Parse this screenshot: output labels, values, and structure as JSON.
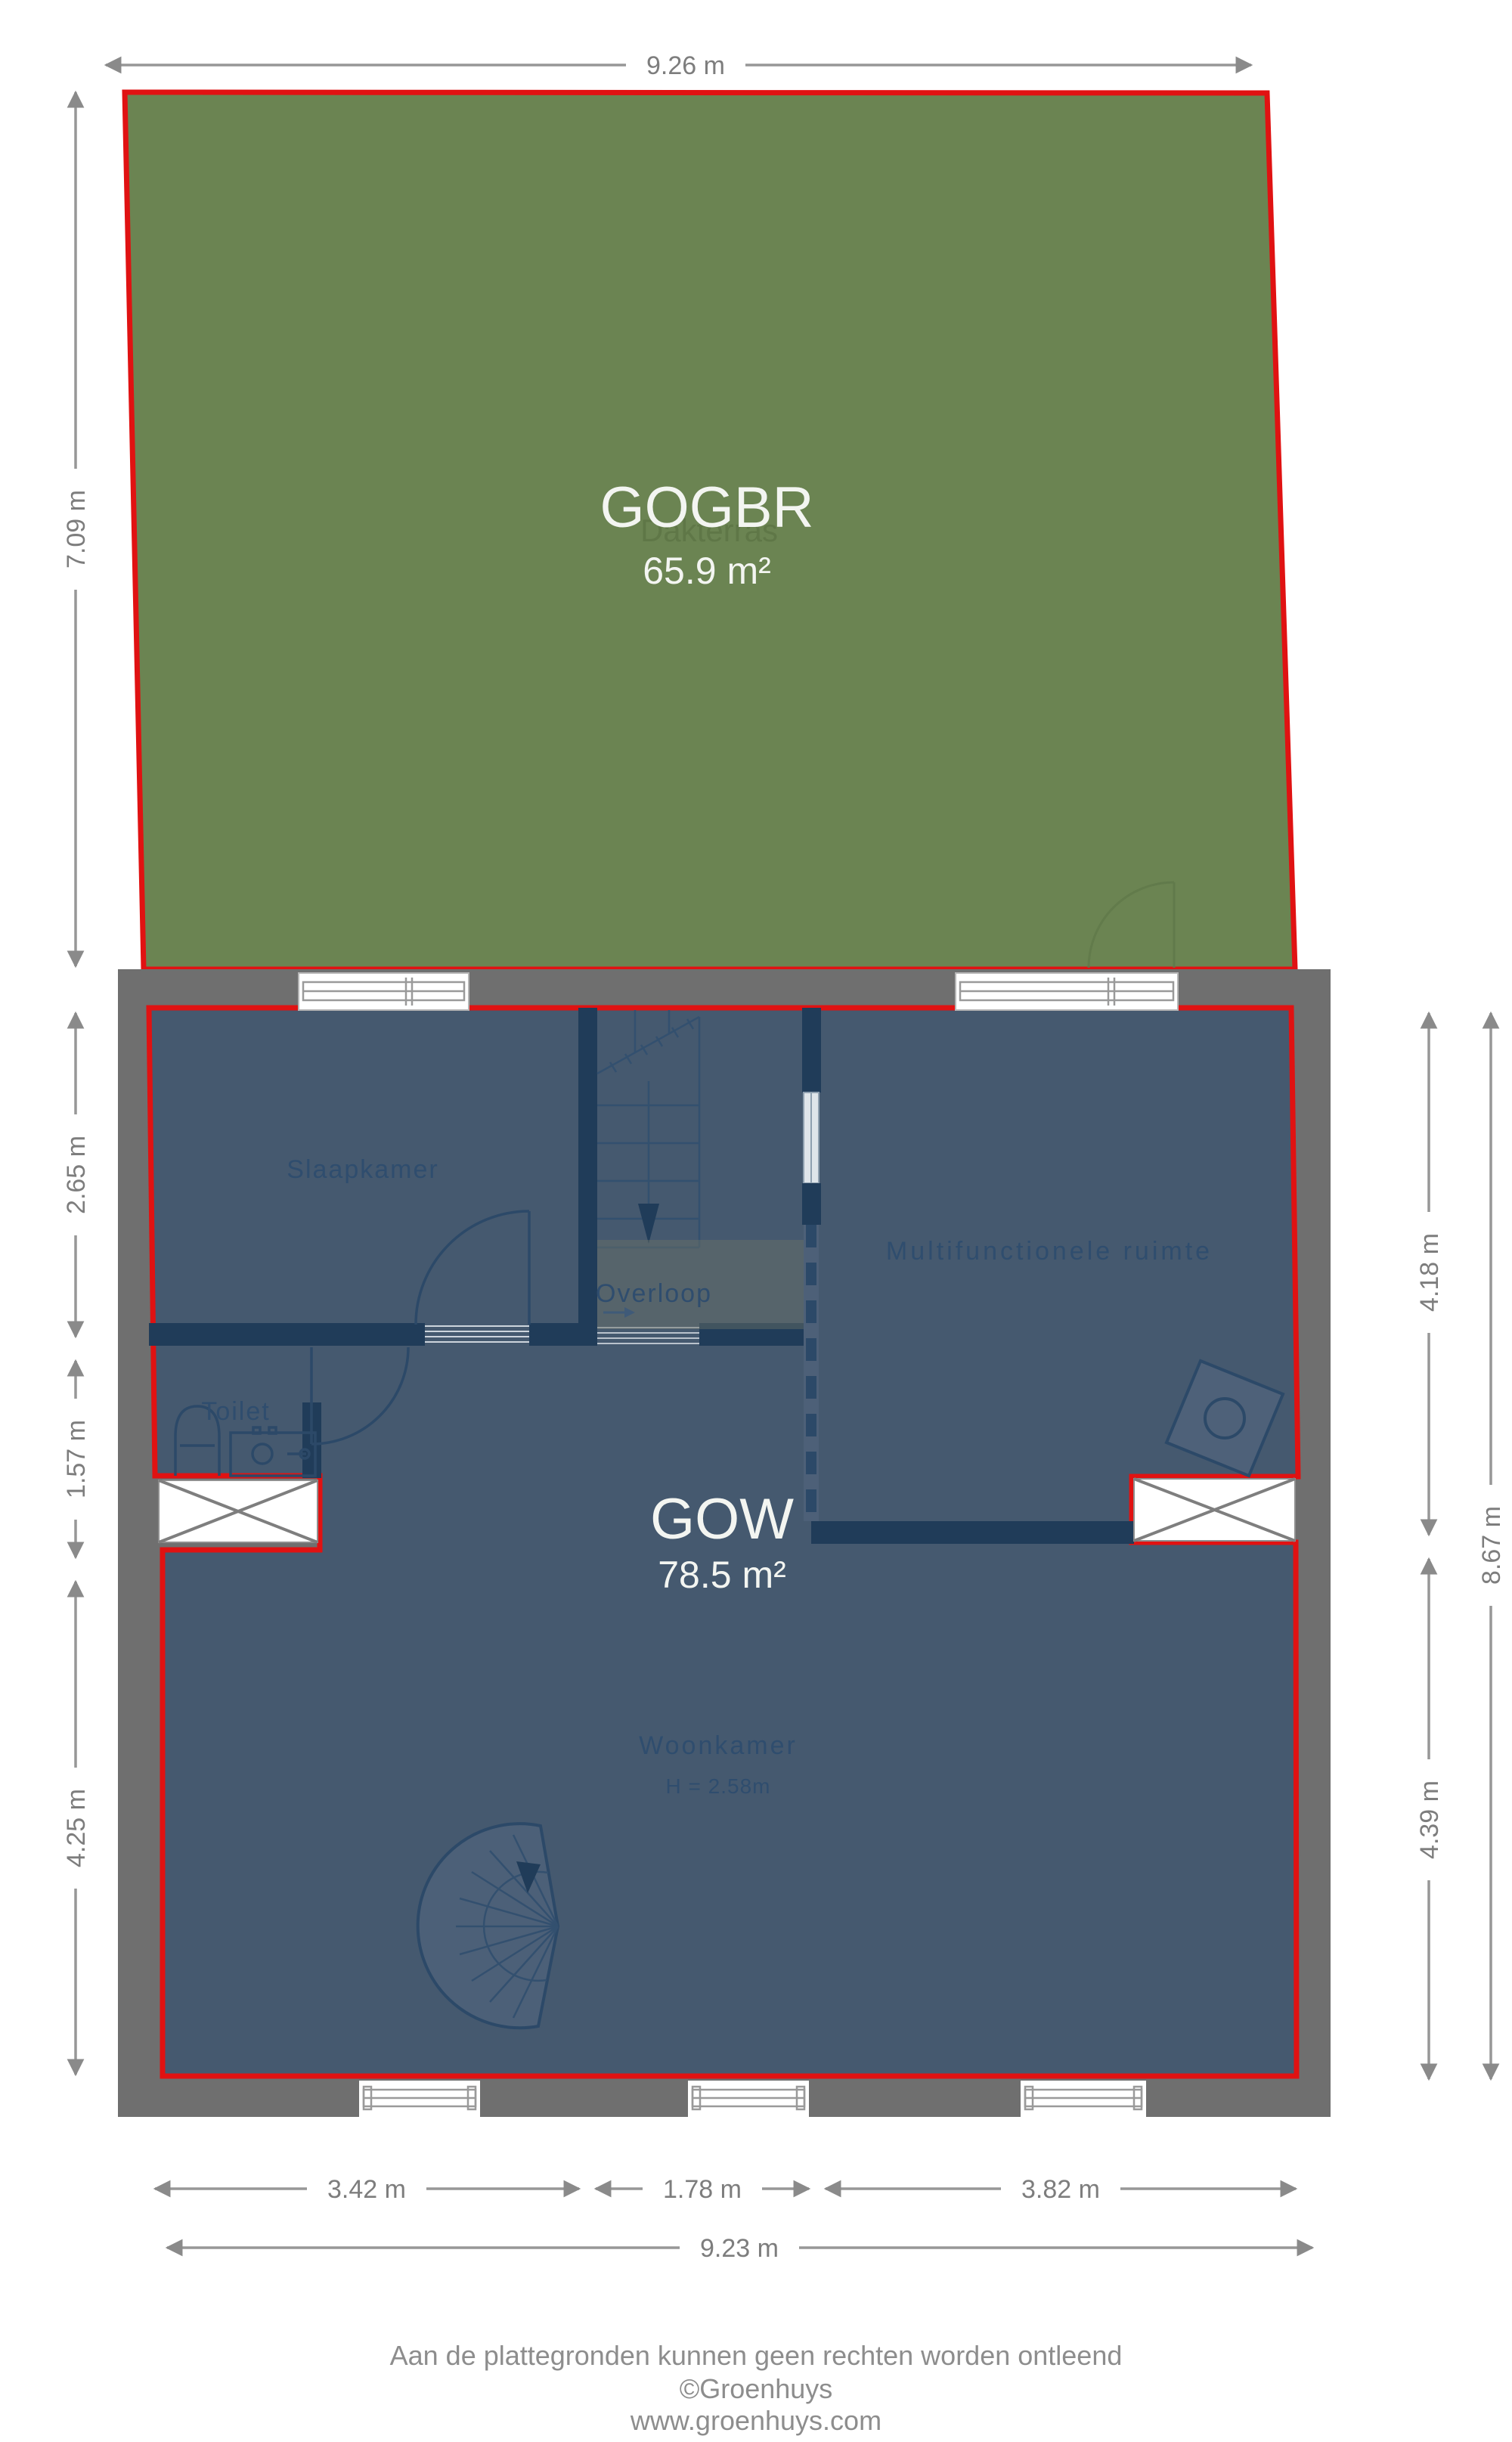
{
  "plan": {
    "terrace": {
      "code": "GOGBR",
      "name": "Dakterras",
      "area": "65.9 m²"
    },
    "floor": {
      "code": "GOW",
      "area": "78.5 m²"
    },
    "rooms": {
      "bedroom": "Slaapkamer",
      "landing": "Overloop",
      "multi": "Multifunctionele ruimte",
      "toilet": "Toilet",
      "living": "Woonkamer",
      "living_height": "H = 2.58m"
    }
  },
  "dimensions": {
    "top": "9.26 m",
    "left_top": "7.09 m",
    "left_upper": "2.65 m",
    "left_mid": "1.57 m",
    "left_lower": "4.25 m",
    "right_upper": "4.18 m",
    "right_lower": "4.39 m",
    "right_total": "8.67 m",
    "bottom_left": "3.42 m",
    "bottom_mid": "1.78 m",
    "bottom_right": "3.82 m",
    "bottom_total": "9.23 m"
  },
  "footer": {
    "line1": "Aan de plattegronden kunnen geen rechten worden ontleend",
    "line2": "©Groenhuys",
    "line3": "www.groenhuys.com"
  },
  "colors": {
    "terrace_fill": "#6b8452",
    "outline_red": "#e01212",
    "wall_gray": "#6f6f6f",
    "room_blue": "#45596f",
    "wall_navy": "#203c59",
    "dim_gray": "#8a8a8a",
    "label_blue": "#2f4d6e",
    "area_text": "#f3f5f1"
  }
}
